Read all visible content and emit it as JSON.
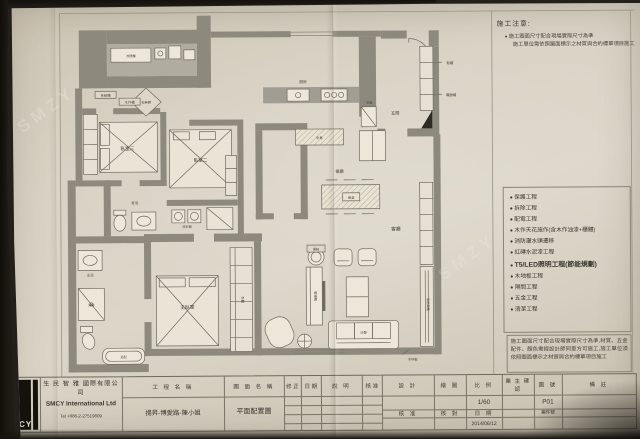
{
  "sheet": {
    "watermark_text": "SMZY",
    "notes_title": "施工注意:",
    "note_line1": "施工圖面尺寸配合現場實際尺寸為準",
    "note_line2": "施工單位需依照圖面標示之材質與合約標單項目施工",
    "work_items": [
      "保護工程",
      "拆除工程",
      "配電工程",
      "木作天花施作(含木作油漆+櫃體)",
      "消防灑水頭遷移",
      "紅磚水泥漆工程",
      "T5/LED照明工程(節能規劃)",
      "木地板工程",
      "隔間工程",
      "五金工程",
      "清潔工程"
    ],
    "bottom_note": "施工圖面尺寸配合現場實際尺寸為準,材質、五金配件、顏色需經設計師同意方可施工,施工單位須依照圖面標示之材質與合約標單項目施工"
  },
  "title_block": {
    "logo_text": "CY",
    "company_cn": "生 民 智 雅 國際有限公司",
    "company_en": "SMCY International Ltd",
    "tel": "Tel +886-2-27519809",
    "project_label": "工 程 名 稱",
    "project_name": "揚昇-博愛路-陳小姐",
    "drawing_label": "圖 面 名 稱",
    "drawing_name": "平面配置圖",
    "rev_label": "修 正",
    "date_label": "日 期",
    "desc_label": "說   明",
    "approve_label": "核 准",
    "design_label": "設 計",
    "draft_label": "繪 圖",
    "scale_label": "比 例",
    "owner_label": "業 主 確 認",
    "dwgno_label": "圖 號",
    "remark_label": "備   註",
    "check_label": "核 對",
    "case_label": "案件號",
    "scale_value": "1/60",
    "dwgno_value": "P01",
    "date_value": "2014/06/12"
  },
  "plan": {
    "labels": {
      "counter": "流理檯",
      "tag1": "系統櫃",
      "tag2": "木作櫃",
      "diamond": "石英磚",
      "bed3": "臥室三",
      "bed2": "臥室二",
      "laundry": "洗衣機",
      "bathg": "客浴",
      "master": "主臥室",
      "wardrobe": "衣櫃",
      "shower": "淋浴",
      "tub": "浴缸",
      "bathm": "主浴",
      "kitchen": "廚房",
      "island": "中島",
      "fridge": "冰箱",
      "dining": "餐廳",
      "table": "餐桌",
      "entry": "玄關",
      "shoe": "鞋櫃",
      "appliance": "電器櫃",
      "living": "客廳",
      "tv": "電視櫃",
      "sofa": "沙發",
      "chair": "單椅",
      "hicab": "系統高櫃",
      "floor": "木地板"
    }
  }
}
